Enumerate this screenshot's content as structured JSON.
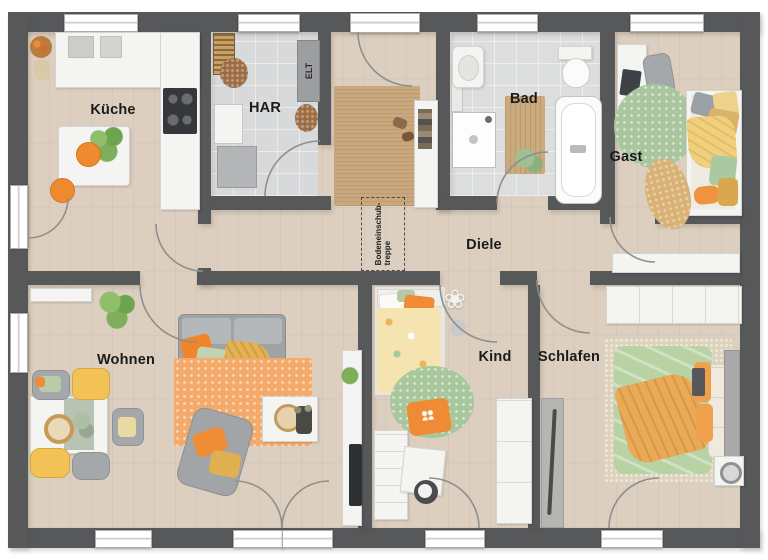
{
  "rooms": [
    {
      "id": "kueche",
      "label": "Küche"
    },
    {
      "id": "har",
      "label": "HAR"
    },
    {
      "id": "bad",
      "label": "Bad"
    },
    {
      "id": "gast",
      "label": "Gast"
    },
    {
      "id": "diele",
      "label": "Diele"
    },
    {
      "id": "wohnen",
      "label": "Wohnen"
    },
    {
      "id": "kind",
      "label": "Kind"
    },
    {
      "id": "schlafen",
      "label": "Schlafen"
    }
  ],
  "annotations": {
    "electrical": "ELT",
    "attic_stairs_line1": "Bodeneinschub-",
    "attic_stairs_line2": "treppe"
  },
  "colors": {
    "wall": "#57585a",
    "wood_floor": "#dccfc0",
    "tile_floor": "#d8d9da",
    "accent_orange": "#ef8c35",
    "accent_yellow": "#f0c75e",
    "accent_sage": "#b8d2a4",
    "rug_orange": "#f3aa6b",
    "rug_jute": "#c9a87e",
    "label_text": "#1b1b1b"
  }
}
